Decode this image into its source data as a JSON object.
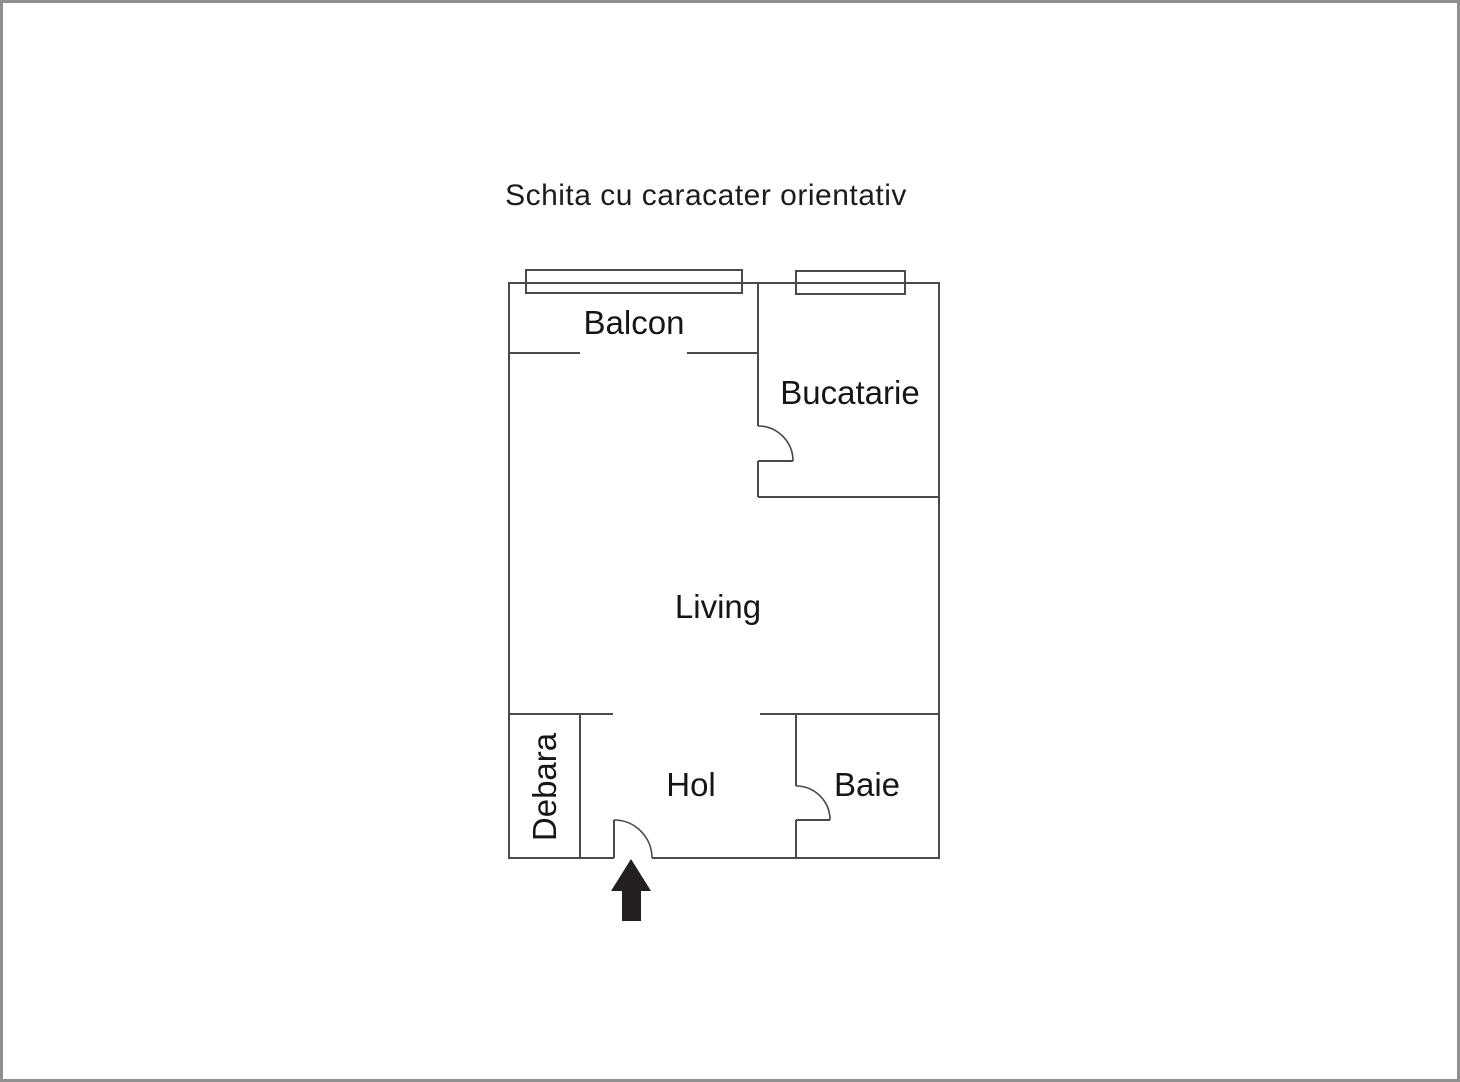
{
  "title": "Schita cu caracater orientativ",
  "floor_plan": {
    "rooms": [
      {
        "id": "balcon",
        "label": "Balcon"
      },
      {
        "id": "bucatarie",
        "label": "Bucatarie"
      },
      {
        "id": "living",
        "label": "Living"
      },
      {
        "id": "debara",
        "label": "Debara"
      },
      {
        "id": "hol",
        "label": "Hol"
      },
      {
        "id": "baie",
        "label": "Baie"
      }
    ],
    "features": {
      "windows": 2,
      "doors": [
        "bucatarie-door",
        "baie-door",
        "entrance-door"
      ],
      "entrance_arrow_direction": "up"
    },
    "colors": {
      "wall": "#4a4a4a",
      "text": "#161616",
      "arrow": "#231f20",
      "canvas_border": "#8f8f8f",
      "background": "#ffffff"
    }
  }
}
